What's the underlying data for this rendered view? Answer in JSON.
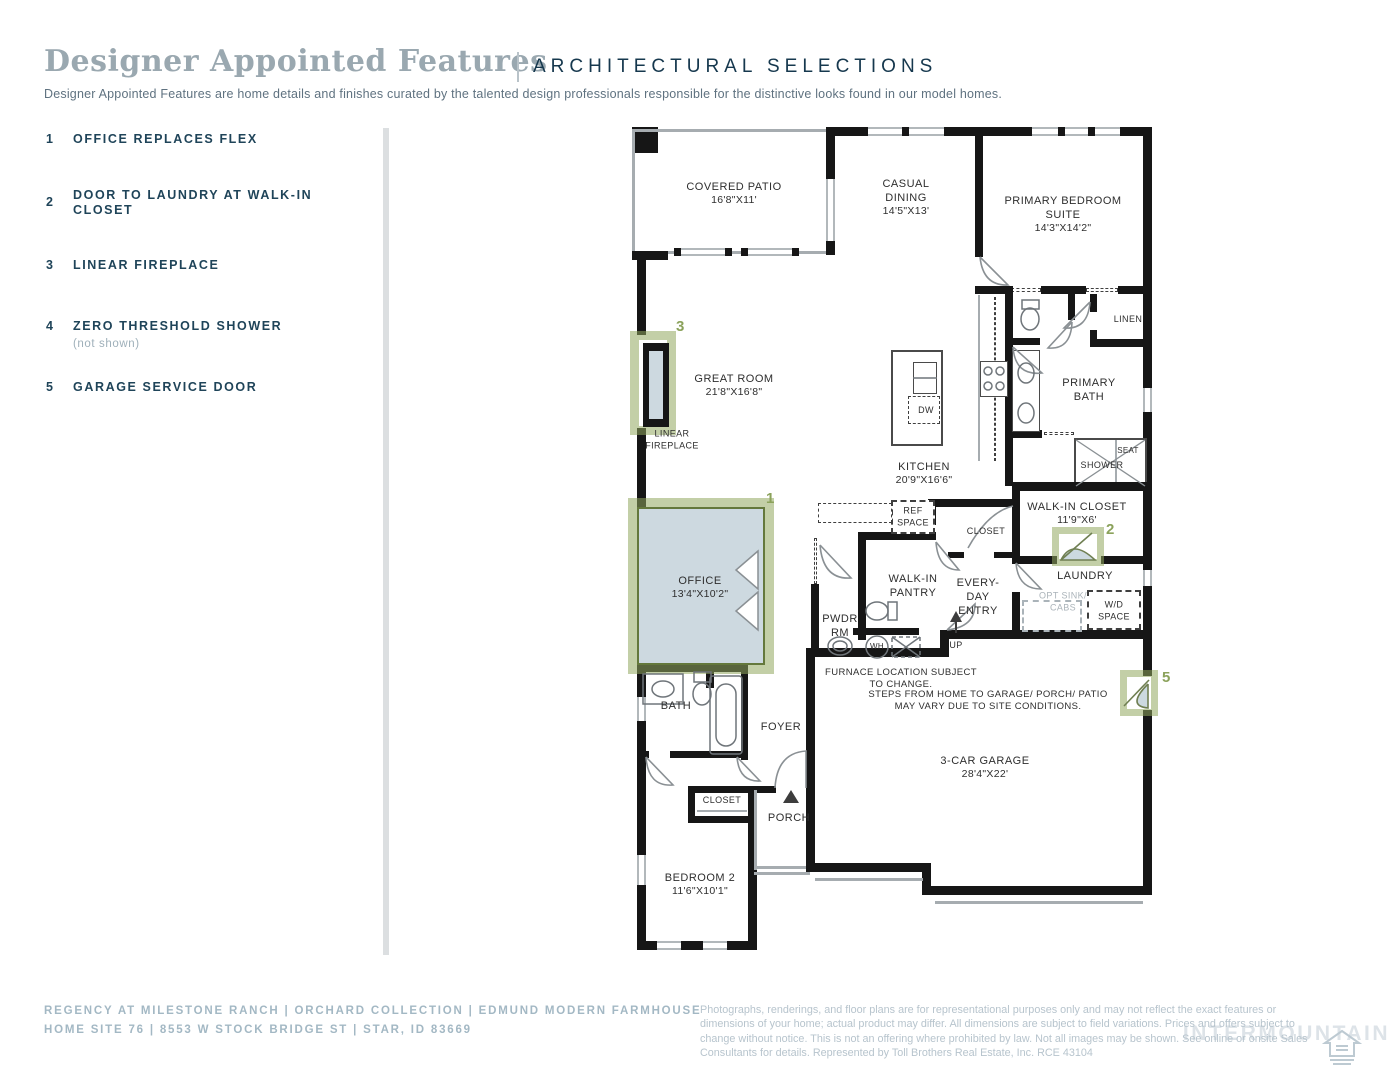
{
  "header": {
    "title": "Designer Appointed Features",
    "tagline": "ARCHITECTURAL SELECTIONS",
    "description": "Designer Appointed Features are home details and finishes curated by the talented design professionals responsible for the distinctive looks found in our model homes."
  },
  "features": [
    {
      "num": "1",
      "label": "OFFICE REPLACES FLEX",
      "note": ""
    },
    {
      "num": "2",
      "label": "DOOR TO LAUNDRY AT WALK-IN CLOSET",
      "note": ""
    },
    {
      "num": "3",
      "label": "LINEAR FIREPLACE",
      "note": ""
    },
    {
      "num": "4",
      "label": "ZERO THRESHOLD SHOWER",
      "note": "(not shown)"
    },
    {
      "num": "5",
      "label": "GARAGE SERVICE DOOR",
      "note": ""
    }
  ],
  "markers": {
    "m1": "1",
    "m2": "2",
    "m3": "3",
    "m5": "5"
  },
  "rooms": {
    "covered_patio": {
      "n": "COVERED PATIO",
      "d": "16'8\"X11'"
    },
    "casual_dining": {
      "n": "CASUAL DINING",
      "d": "14'5\"X13'"
    },
    "primary_suite": {
      "n": "PRIMARY BEDROOM SUITE",
      "d": "14'3\"X14'2\""
    },
    "linen": {
      "n": "LINEN"
    },
    "primary_bath": {
      "n": "PRIMARY BATH"
    },
    "seat": {
      "n": "SEAT"
    },
    "shower": {
      "n": "SHOWER"
    },
    "great_room": {
      "n": "GREAT ROOM",
      "d": "21'8\"X16'8\""
    },
    "linear_fireplace": {
      "n": "LINEAR FIREPLACE"
    },
    "kitchen": {
      "n": "KITCHEN",
      "d": "20'9\"X16'6\""
    },
    "dw": {
      "n": "DW"
    },
    "ref_space": {
      "n": "REF SPACE"
    },
    "walk_in_closet": {
      "n": "WALK-IN CLOSET",
      "d": "11'9\"X6'"
    },
    "stair_closet": {
      "n": "CLOSET"
    },
    "walk_in_pantry": {
      "n": "WALK-IN PANTRY"
    },
    "everyday_entry": {
      "n": "EVERY-DAY ENTRY"
    },
    "laundry": {
      "n": "LAUNDRY"
    },
    "opt_sink": {
      "n": "OPT SINK/ CABS"
    },
    "wd_space": {
      "n": "W/D SPACE"
    },
    "pwdr": {
      "n": "PWDR RM"
    },
    "wh": {
      "n": "WH"
    },
    "up": {
      "n": "UP"
    },
    "office": {
      "n": "OFFICE",
      "d": "13'4\"X10'2\""
    },
    "bath": {
      "n": "BATH"
    },
    "foyer": {
      "n": "FOYER"
    },
    "hall_closet": {
      "n": "CLOSET"
    },
    "porch": {
      "n": "PORCH"
    },
    "garage": {
      "n": "3-CAR GARAGE",
      "d": "28'4\"X22'"
    },
    "bedroom2": {
      "n": "BEDROOM 2",
      "d": "11'6\"X10'1\""
    }
  },
  "notes": {
    "furnace": "FURNACE LOCATION SUBJECT TO CHANGE.",
    "steps": "STEPS FROM HOME TO GARAGE/ PORCH/ PATIO MAY VARY DUE TO SITE CONDITIONS."
  },
  "footer": {
    "line1": "REGENCY AT MILESTONE RANCH  |  ORCHARD COLLECTION  |  EDMUND MODERN FARMHOUSE",
    "line2": "HOME SITE 76  |  8553 W STOCK BRIDGE ST  |  STAR, ID 83669",
    "disclaimer": "Photographs, renderings, and floor plans are for representational purposes only and may not reflect the exact features or dimensions of your home; actual product may differ. All dimensions are subject to field variations. Prices and offers subject to change without notice. This is not an offering where prohibited by law. Not all images may be shown. See online or onsite Sales Consultants for details. Represented by Toll Brothers Real Estate, Inc. RCE 43104",
    "watermark": "INTERMOUNTAIN"
  },
  "colors": {
    "accent_green": "#8ba25b",
    "navy": "#1f4459",
    "office_fill": "#cdd9e0",
    "wall": "#161616"
  }
}
